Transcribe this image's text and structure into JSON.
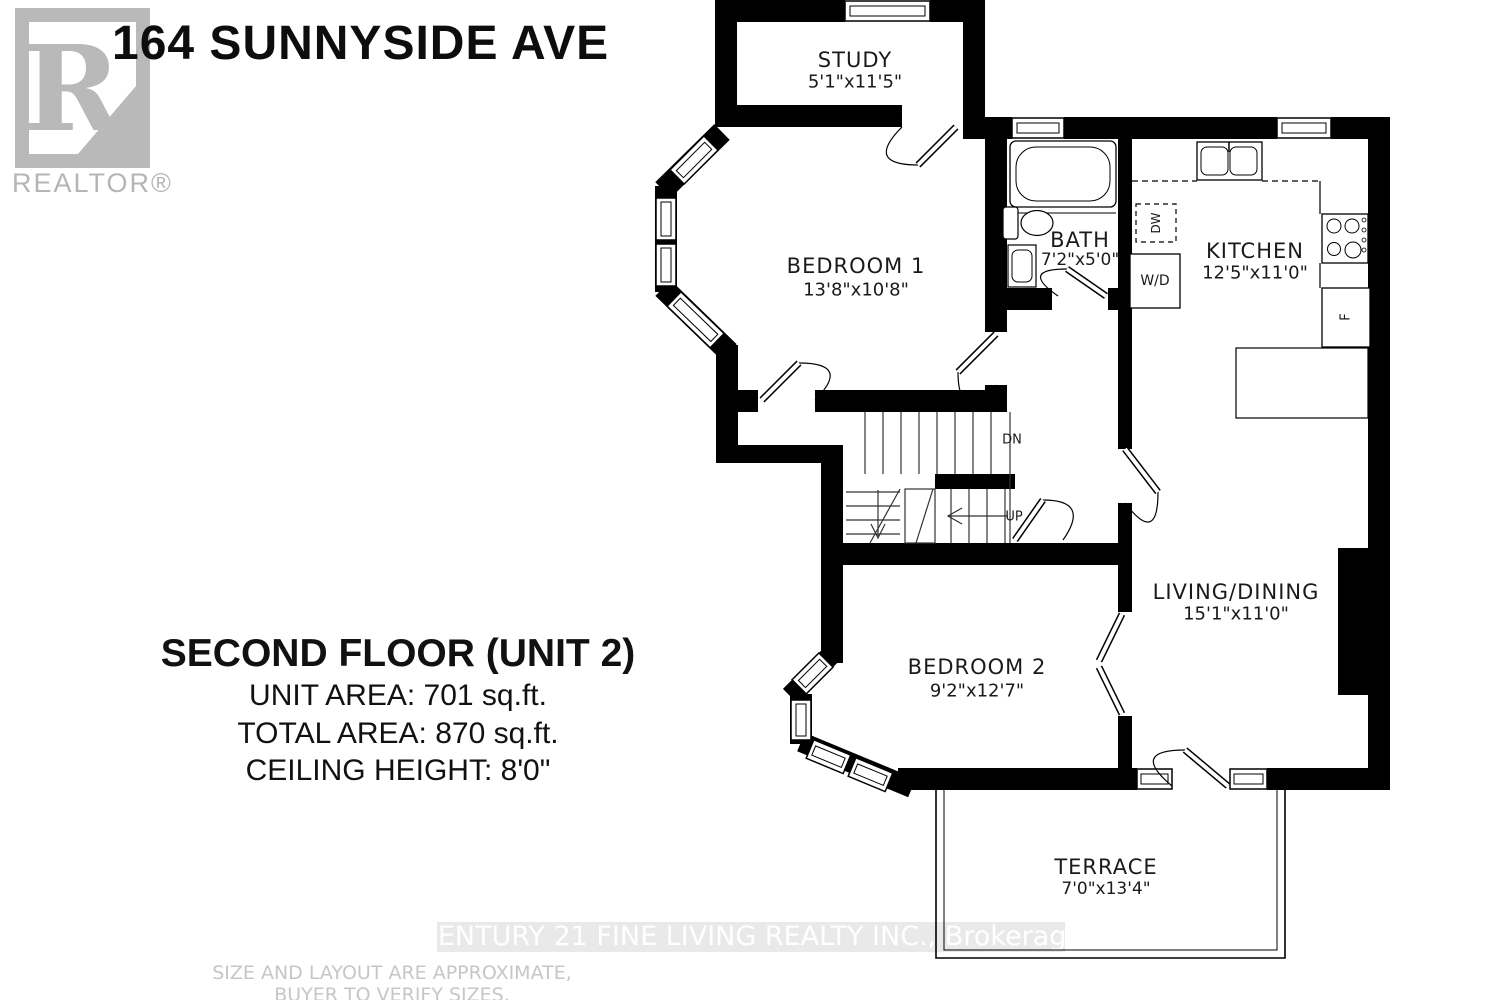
{
  "title": "164 SUNNYSIDE AVE",
  "logo": {
    "letter": "R",
    "label": "REALTOR®"
  },
  "info": {
    "floor": "SECOND FLOOR (UNIT 2)",
    "unit_area": "UNIT AREA: 701 sq.ft.",
    "total_area": "TOTAL AREA: 870 sq.ft.",
    "ceiling": "CEILING HEIGHT: 8'0\""
  },
  "rooms": {
    "study": {
      "name": "STUDY",
      "dims": "5'1\"x11'5\""
    },
    "bedroom1": {
      "name": "BEDROOM 1",
      "dims": "13'8\"x10'8\""
    },
    "bath": {
      "name": "BATH",
      "dims": "7'2\"x5'0\""
    },
    "kitchen": {
      "name": "KITCHEN",
      "dims": "12'5\"x11'0\""
    },
    "living": {
      "name": "LIVING/DINING",
      "dims": "15'1\"x11'0\""
    },
    "bedroom2": {
      "name": "BEDROOM 2",
      "dims": "9'2\"x12'7\""
    },
    "terrace": {
      "name": "TERRACE",
      "dims": "7'0\"x13'4\""
    }
  },
  "plan_labels": {
    "down": "DN",
    "up": "UP",
    "washer_dryer": "W/D",
    "dishwasher": "DW",
    "fridge": "F"
  },
  "watermark": "CENTURY 21 FINE LIVING REALTY INC., Brokerage",
  "disclaimer_line1": "SIZE AND LAYOUT ARE APPROXIMATE,",
  "disclaimer_line2": "BUYER TO VERIFY SIZES.",
  "colors": {
    "wall": "#000000",
    "watermark_band": "#e9e9e9",
    "watermark_text": "#ffffff",
    "logo_gray": "#b9b9b9",
    "disclaimer_gray": "#c6c6c6"
  }
}
